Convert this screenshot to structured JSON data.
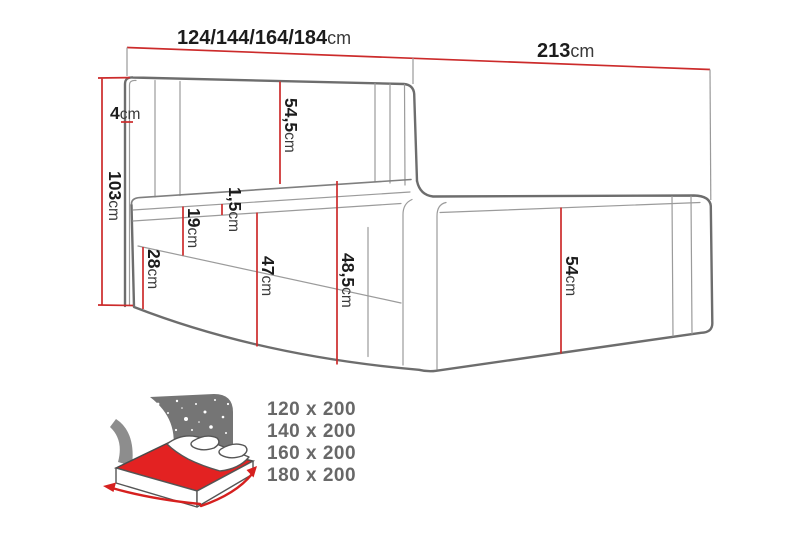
{
  "diagram": {
    "title_hint": "boxspring bed dimension diagram",
    "width_variants": {
      "value": "124/144/164/184",
      "unit": "cm"
    },
    "total_length": {
      "value": "213",
      "unit": "cm"
    },
    "total_height": {
      "value": "103",
      "unit": "cm"
    },
    "headboard_edge": {
      "value": "4",
      "unit": "cm"
    },
    "headboard_panel": {
      "value": "54,5",
      "unit": "cm"
    },
    "mattress_lip": {
      "value": "1,5",
      "unit": "cm"
    },
    "mattress_height": {
      "value": "19",
      "unit": "cm"
    },
    "drawer_height": {
      "value": "28",
      "unit": "cm"
    },
    "front_height": {
      "value": "47",
      "unit": "cm"
    },
    "corner_height": {
      "value": "48,5",
      "unit": "cm"
    },
    "side_height": {
      "value": "54",
      "unit": "cm"
    }
  },
  "sizes": [
    "120 x 200",
    "140 x 200",
    "160 x 200",
    "180 x 200"
  ],
  "colors": {
    "dimension_red": "#cc2b2b",
    "drawing_gray": "#6d6d6d",
    "icon_gray": "#757575",
    "icon_red": "#e32222",
    "sizes_text_gray": "#686868",
    "background": "#ffffff"
  }
}
